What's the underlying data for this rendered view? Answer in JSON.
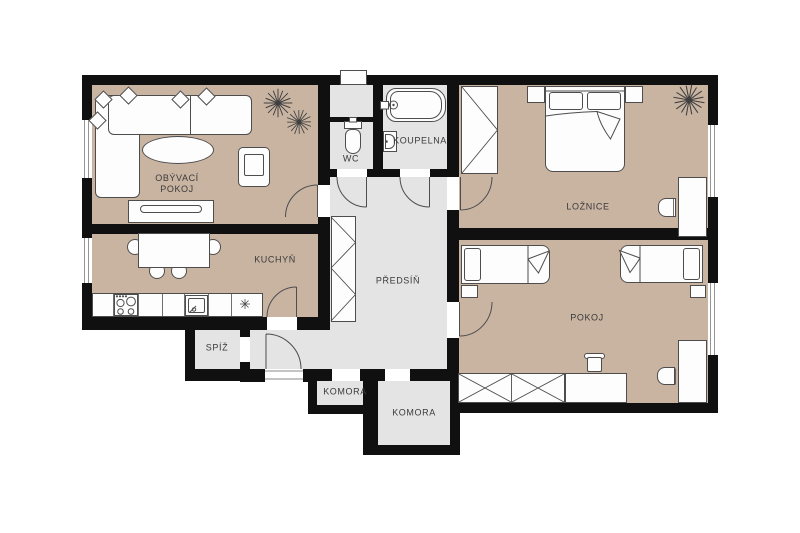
{
  "plan_title": "apartment-floor-plan",
  "rooms": {
    "obyvaci_pokoj": {
      "label": "OBÝVACÍ\nPOKOJ"
    },
    "kuchyn": {
      "label": "KUCHYŇ"
    },
    "spiz": {
      "label": "SPÍŽ"
    },
    "predsin": {
      "label": "PŘEDSÍŇ"
    },
    "wc": {
      "label": "WC"
    },
    "koupelna": {
      "label": "KOUPELNA"
    },
    "loznice": {
      "label": "LOŽNICE"
    },
    "pokoj": {
      "label": "POKOJ"
    },
    "komora_small": {
      "label": "KOMORA"
    },
    "komora_large": {
      "label": "KOMORA"
    }
  },
  "icons": {
    "plant": "spiky-houseplant-star",
    "fridge": "snowflake-asterisk"
  },
  "colors": {
    "wall": "#101010",
    "room_floor": "#c9b4a2",
    "service_floor": "#e4e4e4",
    "furniture_fill": "#fdfdfd",
    "furniture_outline": "#4d4d4d",
    "label_text": "#3a3a3a",
    "background": "#ffffff"
  }
}
